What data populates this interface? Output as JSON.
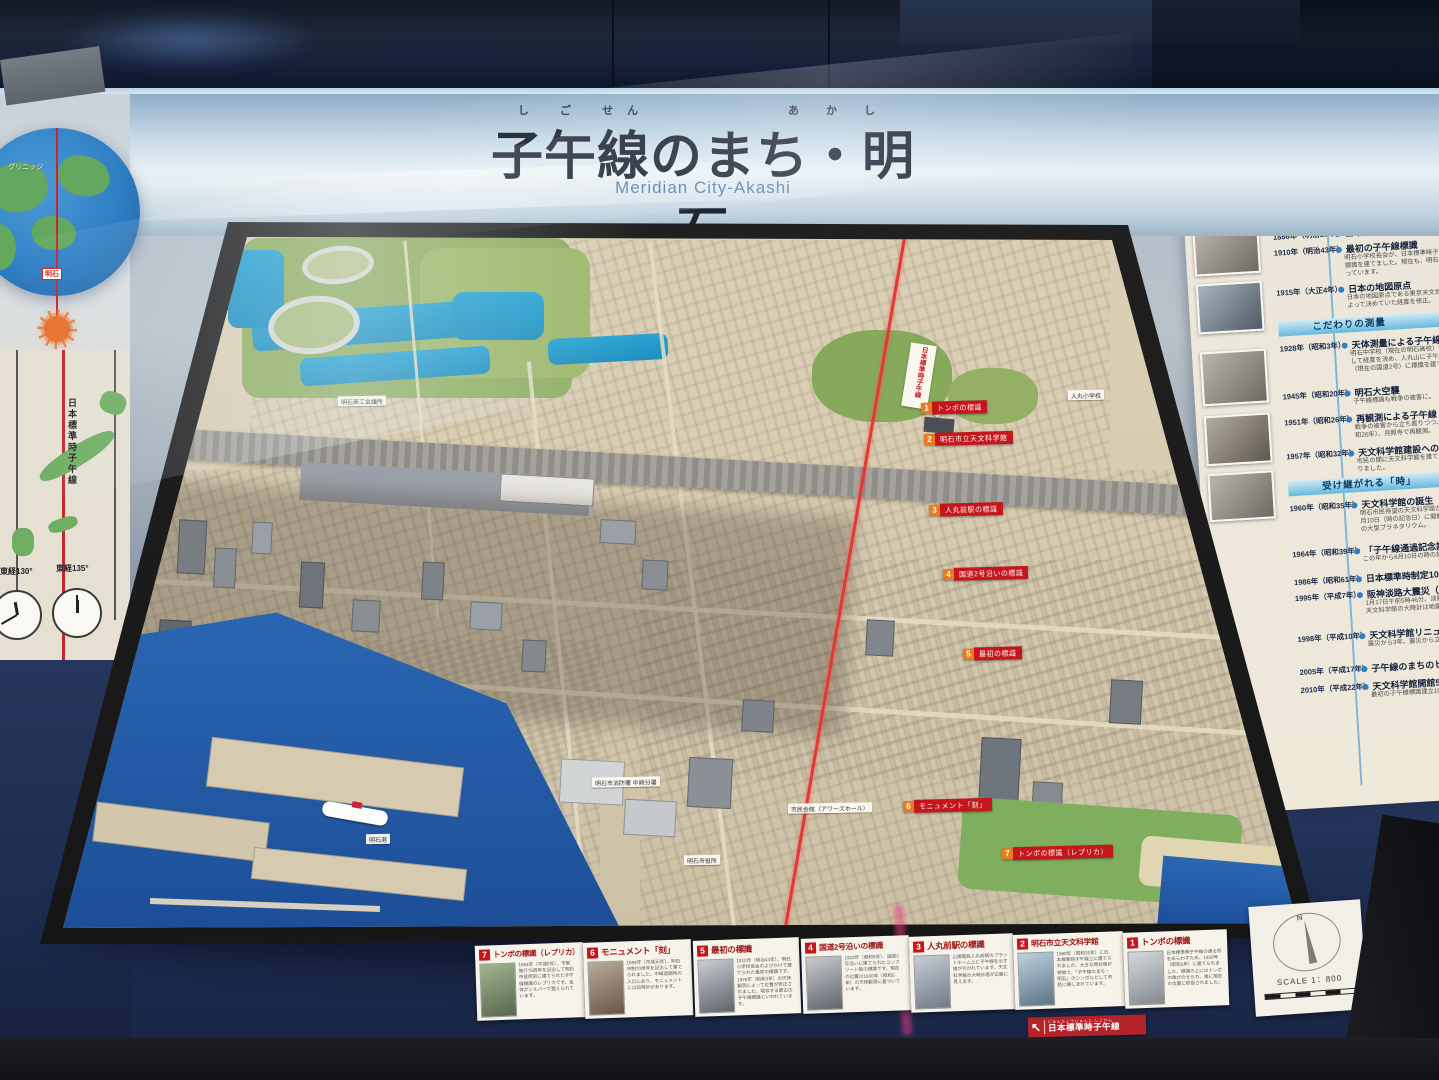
{
  "scene": {
    "title": "子午線のまち・明石",
    "furigana_left": "し ご せん",
    "furigana_right": "あ か し",
    "subtitle": "Meridian City-Akashi"
  },
  "left_panel": {
    "greenwich": "グリニッジ",
    "akashi": "明石",
    "meridian_label": "日本標準時子午線",
    "lon130": "東経130°",
    "lon135": "東経135°"
  },
  "history_panel": {
    "furigana": "あかし　しごせん　れきし",
    "title": "明石と子午線の歴史",
    "subtitle": "History of Akashi and the Meridian",
    "s1": {
      "band": "日本標準時子午線",
      "e": [
        {
          "y": "1884年（明治17年）",
          "t": "国際子午線会議",
          "d": ""
        },
        {
          "y": "1886年（明治19年）",
          "t": "日本標準時子午線",
          "d": ""
        },
        {
          "y": "1910年（明治43年）",
          "t": "最初の子午線標識",
          "d": "明石小学校長会が、日本標準時子午線上に標識を建てました。現在も、明石市内に残っています。"
        },
        {
          "y": "1915年（大正4年）",
          "t": "日本の地図原点",
          "d": "日本の地図原点である東京天文台の測量によって決めていた経度を修正。"
        }
      ]
    },
    "s2": {
      "band": "こだわりの測量",
      "e": [
        {
          "y": "1928年（昭和3年）",
          "t": "天体測量による子午線",
          "d": "明石中学校（現在の明石高校）で星を観測して経度を決め、人丸山に子午線の標識（現在の国道2号）に標識を建てました。"
        },
        {
          "y": "1945年（昭和20年）",
          "t": "明石大空襲",
          "d": "子午線標識も戦争の被害に。"
        },
        {
          "y": "1951年（昭和26年）",
          "t": "再観測による子午線",
          "d": "戦争の被害から立ち直りつつ、1951年（昭和26年）、月照寺で再観測。"
        },
        {
          "y": "1957年（昭和32年）",
          "t": "天文科学館建設への動き",
          "d": "市民の間に天文科学館を建てる動きが起こりました。"
        }
      ]
    },
    "s3": {
      "band": "受け継がれる「時」",
      "e": [
        {
          "y": "1960年（昭和35年）",
          "t": "天文科学館の誕生",
          "d": "明石市民待望の天文科学館が（昭和35年）6月10日（時の記念日）に開館。イエナ社製の大型プラネタリウム。"
        },
        {
          "y": "1964年（昭和39年）",
          "t": "「子午線通過記念証」",
          "d": "この年から6月10日の時の記念日に発行。"
        },
        {
          "y": "1986年（昭和61年）",
          "t": "日本標準時制定100周年",
          "d": ""
        },
        {
          "y": "1995年（平成7年）",
          "t": "阪神淡路大震災（兵庫県南部地震）",
          "d": "1月17日午前5時46分、淡路島北部が震源。天文科学館の大時計は地震で停止。"
        },
        {
          "y": "1998年（平成10年）",
          "t": "天文科学館リニューアル",
          "d": "震災から3年、震災から立ち上がりました。"
        },
        {
          "y": "2005年（平成17年）",
          "t": "子午線のまちのヒーロー",
          "d": ""
        },
        {
          "y": "2010年（平成22年）",
          "t": "天文科学館開館50周年",
          "d": "最初の子午線標識建立100年。"
        }
      ]
    }
  },
  "model": {
    "meridian_banner": "日本標準時子午線",
    "markers": [
      {
        "num": "1",
        "label": "トンボの標識"
      },
      {
        "num": "2",
        "label": "明石市立天文科学館"
      },
      {
        "num": "3",
        "label": "人丸前駅の標識"
      },
      {
        "num": "4",
        "label": "国道2号沿いの標識"
      },
      {
        "num": "5",
        "label": "最初の標識"
      },
      {
        "num": "6",
        "label": "モニュメント「刻」"
      },
      {
        "num": "7",
        "label": "トンボの標識（レプリカ）"
      }
    ],
    "labels": [
      "明石商工会議所",
      "人丸小学校",
      "明石市消防署 中崎分署",
      "市民会館（アワーズホール）",
      "明石市役所",
      "明石港"
    ]
  },
  "cards": [
    {
      "num": "7",
      "title": "トンボの標識（レプリカ）",
      "body": "1994年（平成6年）、市制施行75周年を記念して明石市役所前に建てられた子午線標識のレプリカです。全体がシルバーで整えられています。"
    },
    {
      "num": "6",
      "title": "モニュメント「刻」",
      "body": "1989年（平成元年）、明石市制70周年を記念して建てられました。中崎遊園地の入口にあり、モニュメントには日時計があります。"
    },
    {
      "num": "5",
      "title": "最初の標識",
      "body": "1910年（明治43年）、明石小学校長会のよびかけで建てられた最初の標識です。1928年（昭和3年）の天体観測によって位置が修正されました。現存する最古の子午線標識といわれています。"
    },
    {
      "num": "4",
      "title": "国道2号沿いの標識",
      "body": "1933年（昭和8年）、国道2号沿いに建てられたコンクリート製の標識です。現在の位置は1930年（昭和5年）の天体観測に基づいています。"
    },
    {
      "num": "3",
      "title": "人丸前駅の標識",
      "body": "山陽電鉄人丸前駅のプラットホーム上に子午線を示す線が引かれています。天文科学館の大時計塔が正面に見えます。"
    },
    {
      "num": "2",
      "title": "明石市立天文科学館",
      "body": "1960年（昭和35年）に日本標準時子午線上に建てられました。大きな時計塔が特徴で、「子午線のまち・明石」のシンボルとして市民に親しまれています。"
    },
    {
      "num": "1",
      "title": "トンボの標識",
      "body": "日本標準時子午線の通る所をあらわすため、1930年（昭和5年）に建てられました。標識の上にはトンボの像がのせられ、後に現在の位置に移設されました。"
    }
  ],
  "scale_card": {
    "north": "N",
    "text": "SCALE 1：800"
  },
  "floor_banner": {
    "arrow": "↖",
    "furigana": "にほんひょうじゅんじ しごせん",
    "text": "日本標準時子午線"
  }
}
